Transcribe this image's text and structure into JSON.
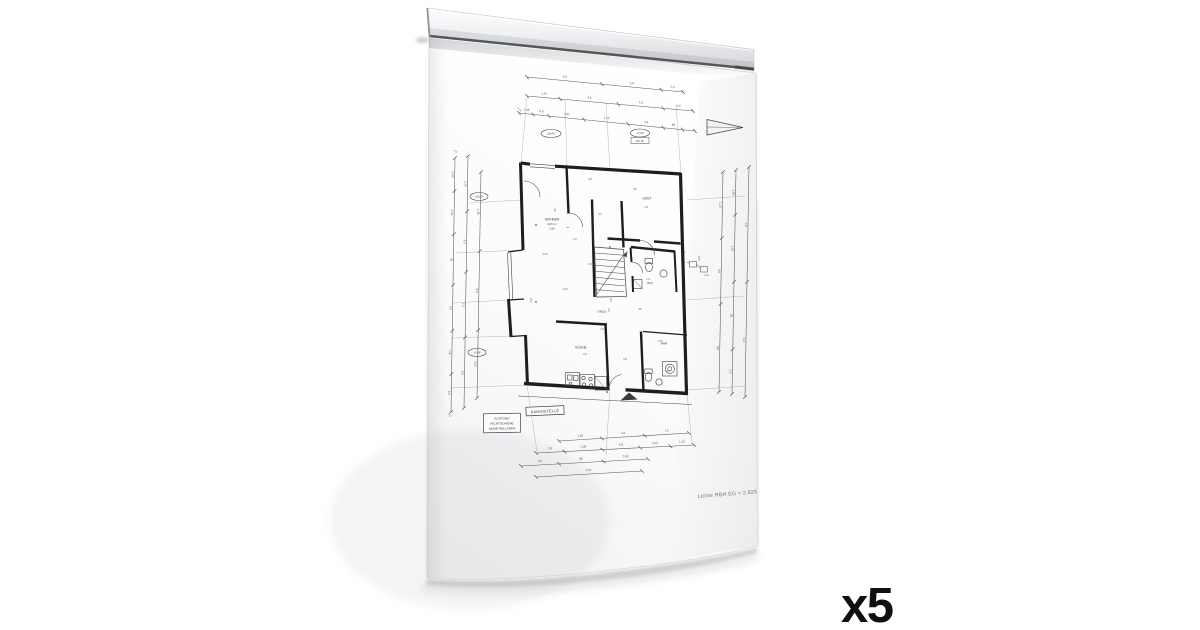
{
  "overlay": {
    "quantity_label": "x5"
  },
  "scene": {
    "background_color": "#ffffff",
    "rail": {
      "description": "magnetic clamp rail holding sheet",
      "color_top": "#fbfcfd",
      "color_bottom": "#cfd2d5",
      "edge_color": "#54575c"
    },
    "paper": {
      "color": "#fdfdfe",
      "shade_color": "#ededef"
    }
  },
  "floor_plan": {
    "ink_color": "#45474b",
    "wall_color": "#1d1e20",
    "dim_color": "#55575a",
    "note_bottom_right": "Lichte RBH EG = 2.625",
    "rooms": {
      "wohnen_lines": [
        "WOHNEN",
        "20,5 m²",
        "2,50"
      ],
      "gast": "GAST",
      "kueche": "KÜCHE",
      "diele": "DIELE",
      "bad": "BAD",
      "hwr": "HWR"
    },
    "kamin_box_label": "KAMINSTELLE",
    "note_box_lines": [
      "ACHTUNG",
      "RICHTSCHIENE",
      "OHNE ROLLADEN"
    ],
    "level_ovals": [
      "±0,00",
      "-0,30",
      "±0,00",
      "-0,38"
    ],
    "under_oval_label": "OK FF",
    "dim_labels": [
      "3,5",
      "1,8",
      "2,0",
      "1,25",
      "4,5",
      "1,5",
      "2,6",
      "1,38",
      "5,8",
      "2,01",
      "1,13",
      "3,8",
      "88",
      "2,63",
      "1,01",
      "36"
    ]
  }
}
